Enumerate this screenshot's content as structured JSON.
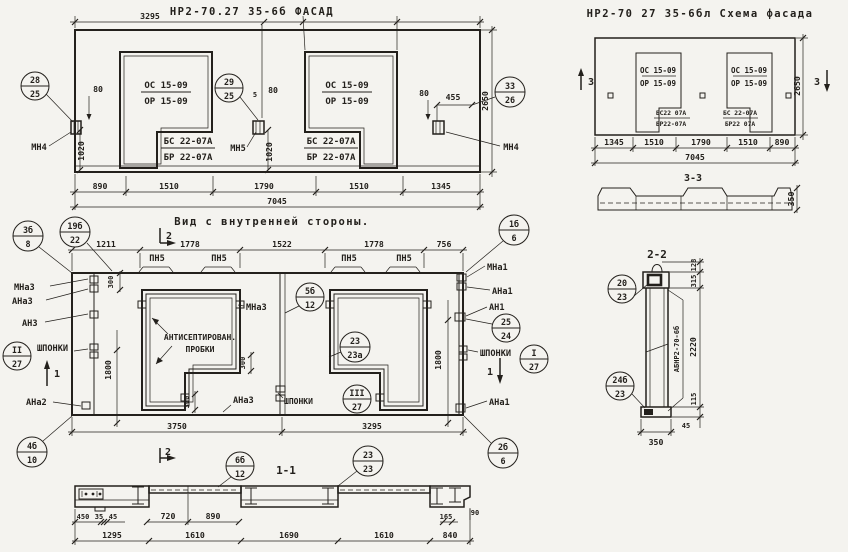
{
  "facade": {
    "title": "НР2-70.27 35-6б  ФАСАД",
    "dim_top": "3295",
    "dims_bottom": [
      "890",
      "1510",
      "1790",
      "1510",
      "1345"
    ],
    "dim_total": "7045",
    "dim_height": "2650",
    "dim_80_left": "80",
    "dim_1020_left": "1020",
    "dim_5_mid": "5",
    "dim_80_mid": "80",
    "dim_1020_mid": "1020",
    "dim_80_right": "80",
    "dim_455": "455",
    "win1": {
      "line1": "ОС 15-09",
      "line2": "ОР 15-09",
      "sub1": "БС 22-07А",
      "sub2": "БР 22-07А"
    },
    "win2": {
      "line1": "ОС 15-09",
      "line2": "ОР 15-09",
      "sub1": "БС 22-07А",
      "sub2": "БР 22-07А"
    },
    "mark_left": "МН4",
    "mark_mid": "МН5",
    "mark_right": "МН4",
    "balloon_left": {
      "top": "28",
      "bottom": "25"
    },
    "balloon_mid": {
      "top": "29",
      "bottom": "25"
    },
    "balloon_right": {
      "top": "33",
      "bottom": "26"
    }
  },
  "inner": {
    "title": "Вид с внутренней стороны.",
    "dims_top": [
      "1211",
      "1778",
      "1522",
      "1778",
      "756"
    ],
    "dim_3750": "3750",
    "dim_3295": "3295",
    "dim_1800_left": "1800",
    "dim_1800_right": "1800",
    "dim_300_a": "300",
    "dim_300_b": "300",
    "dim_300_c": "300",
    "pn5": "ПН5",
    "shponki": "ШПОНКИ",
    "note_line1": "АНТИСЕПТИРОВАН.",
    "note_line2": "ПРОБКИ",
    "lbl_mna3": "МНа3",
    "lbl_ana3": "АНа3",
    "lbl_an3": "АН3",
    "lbl_ana2": "АНа2",
    "lbl_mna3_mid": "МНа3",
    "lbl_ana3_mid": "АНа3",
    "lbl_mna1": "МНа1",
    "lbl_ana1": "АНа1",
    "lbl_an1": "АН1",
    "lbl_ana1_br": "АНа1",
    "sec1": "1",
    "sec2": "2",
    "balloons": {
      "b3b8": {
        "top": "3б",
        "bottom": "8"
      },
      "b19b22": {
        "top": "19б",
        "bottom": "22"
      },
      "b1b6": {
        "top": "1б",
        "bottom": "6"
      },
      "b5b12": {
        "top": "5б",
        "bottom": "12"
      },
      "b2524": {
        "top": "25",
        "bottom": "24"
      },
      "bII27": {
        "top": "II",
        "bottom": "27"
      },
      "bIII27": {
        "top": "III",
        "bottom": "27"
      },
      "bI27": {
        "top": "I",
        "bottom": "27"
      },
      "b2323a": {
        "top": "23",
        "bottom": "23а"
      },
      "b4b10": {
        "top": "4б",
        "bottom": "10"
      },
      "b2b6": {
        "top": "2б",
        "bottom": "6"
      }
    }
  },
  "scheme": {
    "title": "НР2-70 27 35-6бл  Схема фасада",
    "dims_bottom": [
      "1345",
      "1510",
      "1790",
      "1510",
      "890"
    ],
    "dim_total": "7045",
    "dim_height": "2650",
    "sec3": "3",
    "win1": {
      "line1": "ОС 15-09",
      "line2": "ОР 15-09",
      "sub1": "БС22 07А",
      "sub2": "БР22-07А"
    },
    "win2": {
      "line1": "ОС 15-09",
      "line2": "ОР 15-09",
      "sub1": "БС 22-07А",
      "sub2": "БР22 07А"
    }
  },
  "sec33": {
    "title": "3-3",
    "dim_350": "350"
  },
  "sec22": {
    "title": "2-2",
    "label_vert": "АБНР2-70-6б",
    "d128": "128",
    "d315": "315",
    "d2220": "2220",
    "d115": "115",
    "d45": "45",
    "d350": "350",
    "balloon_top": {
      "top": "20",
      "bottom": "23"
    },
    "balloon_bot": {
      "top": "24б",
      "bottom": "23"
    }
  },
  "sec11": {
    "title": "1-1",
    "dims_row1": [
      "450",
      "35",
      "45",
      "720",
      "890",
      "165",
      "90"
    ],
    "dims_row2": [
      "1295",
      "1610",
      "1690",
      "1610",
      "840"
    ],
    "balloon_a": {
      "top": "6б",
      "bottom": "12"
    },
    "balloon_b": {
      "top": "23",
      "bottom": "23"
    }
  }
}
